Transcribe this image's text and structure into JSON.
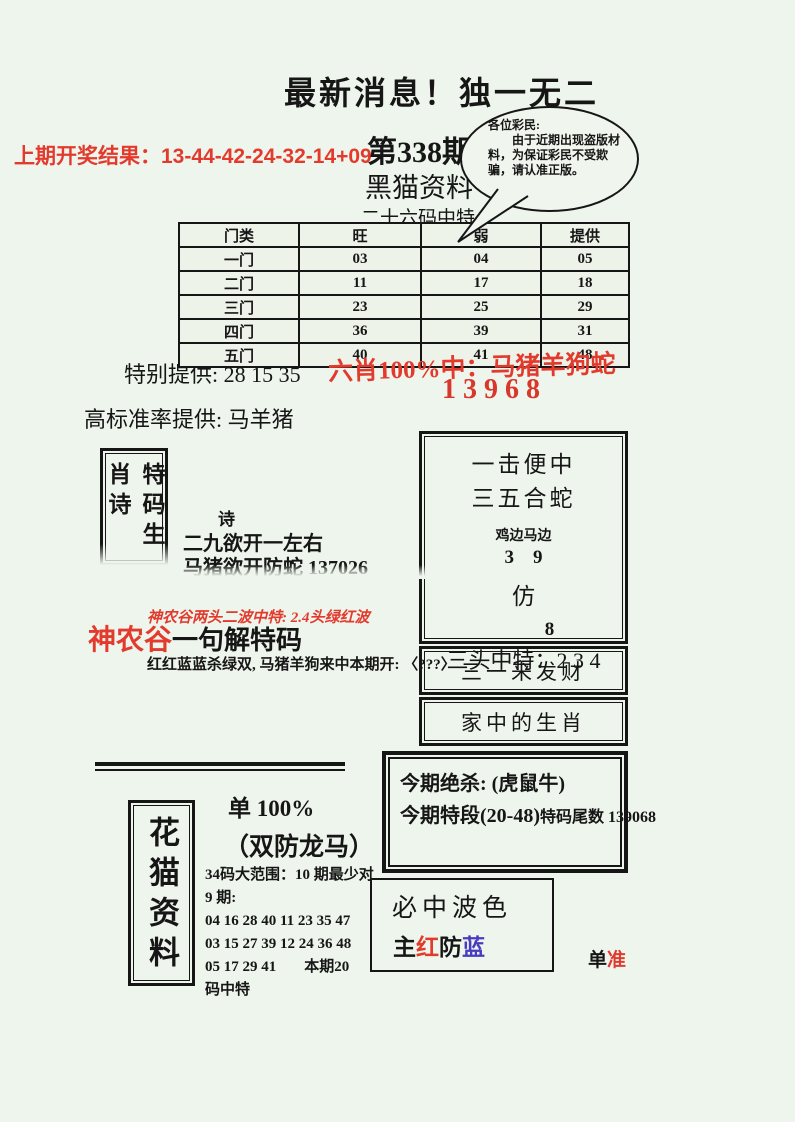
{
  "header": {
    "title": "最新消息！独一无二",
    "prev_result": "上期开奖结果：13-44-42-24-32-14+09",
    "issue": "第338期",
    "brand": "黑猫资料",
    "subtitle": "二十六码中特",
    "bubble": {
      "salutation": "各位彩民:",
      "body": "由于近期出现盗版材料，为保证彩民不受欺骗，请认准正版。"
    }
  },
  "table": {
    "headers": [
      "门类",
      "旺",
      "弱",
      "提供"
    ],
    "rows": [
      [
        "一门",
        "03",
        "04",
        "05"
      ],
      [
        "二门",
        "11",
        "17",
        "18"
      ],
      [
        "三门",
        "23",
        "25",
        "29"
      ],
      [
        "四门",
        "36",
        "39",
        "31"
      ],
      [
        "五门",
        "40",
        "41",
        "48"
      ]
    ]
  },
  "offers": {
    "special": "特别提供: 28 15 35",
    "six_xiao_line": "六肖100%中：马猪羊狗蛇",
    "six_xiao_number": "13968",
    "high_standard": "高标准率提供: 马羊猪"
  },
  "poem": {
    "vertical_title": "特码生肖诗",
    "heading": "诗",
    "line1": "二九欲开一左右",
    "line2": "马猪欲开防蛇 137026"
  },
  "shennong": {
    "red_line": "神农谷两头二波中特: 2.4头绿红波",
    "brand": "神农谷",
    "title": "一句解特码",
    "body": "红红蓝蓝杀绿双, 马猪羊狗来中本期开: 〈???〉"
  },
  "strike_box": {
    "line1": "一击便中",
    "line2": "三五合蛇",
    "line3": "鸡边马边",
    "numbers1": "3    9",
    "line4": "仿",
    "number2": "8",
    "line5": "三头中特：2 3 4"
  },
  "banners": {
    "fortune": "三一来发财",
    "zodiac": "家中的生肖"
  },
  "kill_box": {
    "line1": "今期绝杀: (虎鼠牛)",
    "line2_main": "今期特段(20-48)",
    "line2_tail": "特码尾数 139068"
  },
  "huamao": {
    "vertical_title": "花猫资料",
    "dan_line": "单 100%",
    "shuangfang": "（双防龙马）",
    "range_line1": "34码大范围：10 期最少对",
    "range_line2": "9 期:",
    "numbers1": "04 16 28 40 11 23 35 47",
    "numbers2": "03 15 27 39 12 24 36 48",
    "numbers3": "05 17 29 41",
    "benqi": "本期20",
    "benqi_tail": "码中特"
  },
  "bose_box": {
    "title": "必中波色",
    "main_label": "主",
    "main_color": "红",
    "guard_label": "防",
    "guard_color": "蓝"
  },
  "footer_mark": {
    "black": "单",
    "red": "准"
  },
  "colors": {
    "red": "#e23b2e",
    "blue": "#4a3cc0",
    "background": "#eef5ec"
  }
}
